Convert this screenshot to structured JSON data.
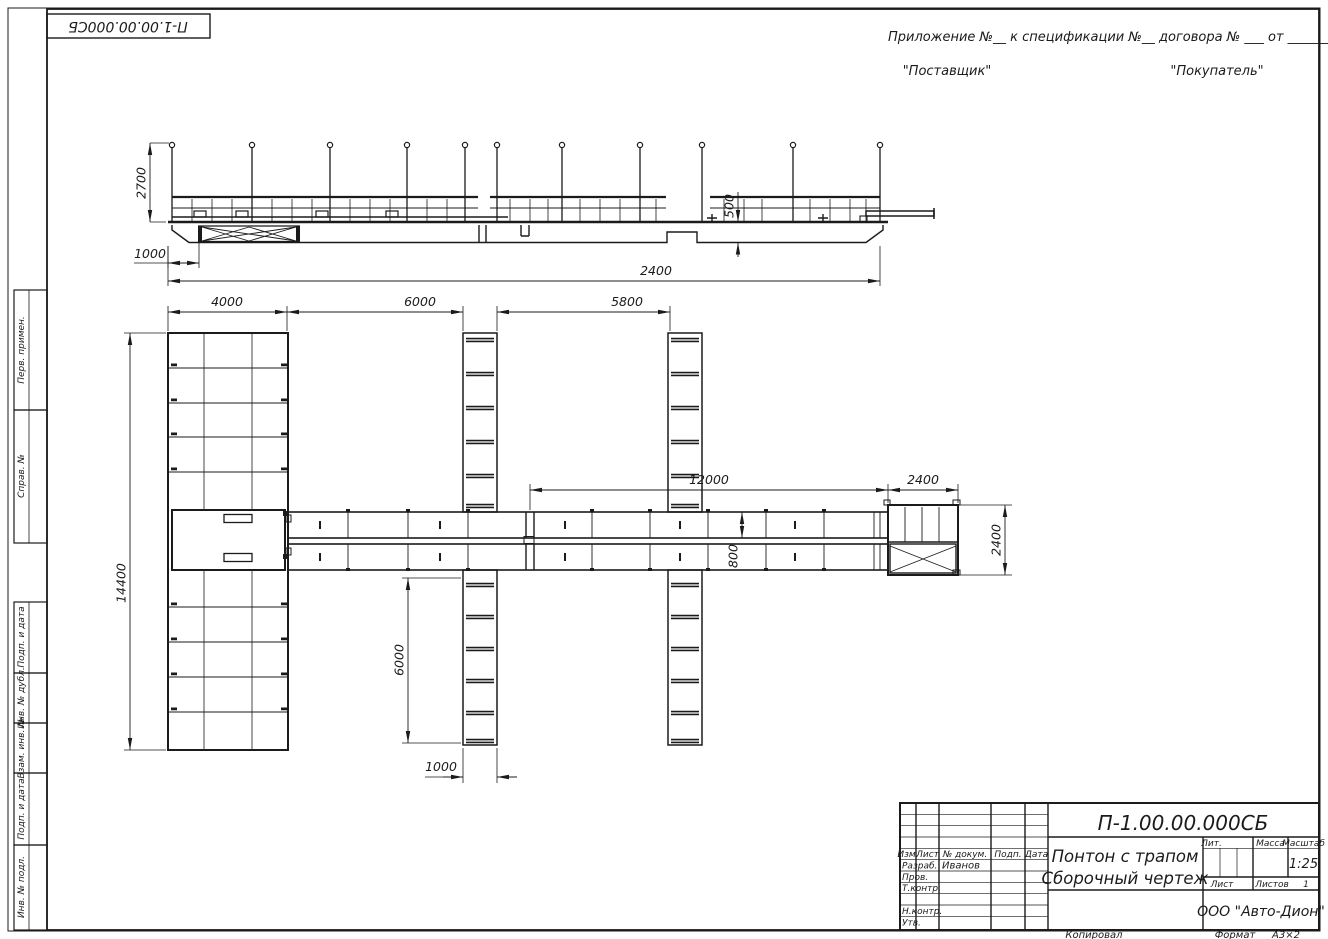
{
  "colors": {
    "ink": "#1b1b1b",
    "paper": "#ffffff"
  },
  "corner_stamp": {
    "doc_number": "П-1.00.00.000СБ"
  },
  "header": {
    "note": "Приложение №__     к спецификации №__    договора № ___  от _________",
    "supplier": "\"Поставщик\"",
    "buyer": "\"Покупатель\""
  },
  "side_labels": {
    "perv": "Перв. примен.",
    "sprav": "Справ. №",
    "podp1": "Подп. и дата",
    "inv_dubl": "Инв. № дубл.",
    "vzam": "Взам. инв. №",
    "podp2": "Подп. и дата",
    "inv_podl": "Инв. № подл."
  },
  "dims": {
    "elev": {
      "h2700": "2700",
      "off1000": "1000",
      "fb500": "500",
      "len2400": "2400"
    },
    "plan": {
      "d4000": "4000",
      "d6000": "6000",
      "d5800": "5800",
      "d12000": "12000",
      "d2400t": "2400",
      "d800": "800",
      "d14400": "14400",
      "f6000": "6000",
      "f1000": "1000",
      "p2400": "2400"
    }
  },
  "title_block": {
    "doc_number": "П-1.00.00.000СБ",
    "name_line1": "Понтон с трапом",
    "name_line2": "Сборочный чертеж",
    "cols": {
      "izm": "Изм.",
      "list": "Лист",
      "doc": "№ докум.",
      "podp": "Подп.",
      "data": "Дата"
    },
    "rows": {
      "razrab": "Разраб.",
      "razrab_value": "Иванов",
      "prov": "Пров.",
      "tkontr": "Т.контр.",
      "nkontr": "Н.контр.",
      "utv": "Утв."
    },
    "lit": "Лит.",
    "massa": "Масса",
    "masshtab": "Масштаб",
    "scale": "1:25",
    "list_label": "Лист",
    "listov_label": "Листов",
    "listov_value": "1",
    "company": "ООО \"Авто-Дион\""
  },
  "footer": {
    "copied": "Копировал",
    "format_label": "Формат",
    "format_value": "А3×2"
  }
}
